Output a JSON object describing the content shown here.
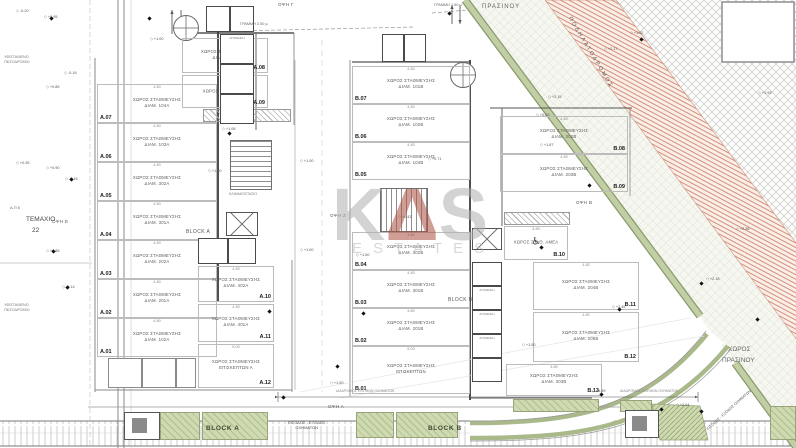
{
  "watermark": {
    "k": "K",
    "delta": "Δ",
    "s": "S",
    "sub": "ESTATES",
    "gray": "#b0b0b0",
    "red": "#ad4f41"
  },
  "areas": {
    "green_top": "ΠΡΑΣΙΝΟΥ",
    "bike_path": "ΠΟΔΗΛΑΤΟΔΡΟΜΟΣ",
    "green_corner_1": "ΧΩΡΟΣ",
    "green_corner_2": "ΠΡΑΣΙΝΟΥ",
    "plot_line1": "ΤΕΜΑΧΙΟ",
    "plot_line2": "22",
    "ap6": "Α.Π 6",
    "sidewalk_note_1": "ΥΦΙΣΤΑΜΕΝΟ",
    "sidewalk_note_2": "ΠΕΖΟΔΡΟΜΙΟ",
    "entry_1": "ΕΙΣΟΔΟΣ - ΕΞΟΔΟΣ",
    "entry_2": "ΟΧΗΜΑΤΩΝ",
    "entry_diag": "ΕΙΣΟΔΟΣ - ΕΞΟΔΟΣ ΟΧΗΜΑΤΩΝ",
    "line_250": "ΓΡΑΜΜΗ 2.50 μ",
    "line_150": "ΓΡΑΜΜΗ 1.50 μ",
    "corridor": "ΔΙΑΔΡΟΜΟΣ ΕΛΙΓΜΩΝ ΟΧΗΜΑΤΩΝ"
  },
  "blocks": {
    "a": "BLOCK A",
    "b": "BLOCK B",
    "a_bottom": "BLOCK A",
    "b_bottom": "BLOCK B"
  },
  "cores": {
    "stair": "ΚΛΙΜΑΚΟΣΤΑΣΙΟ",
    "storage": "ΑΠΟΘΗΚΗ"
  },
  "icons": {
    "wheelchair": "♿"
  },
  "facade_labels": [
    {
      "t": "ΟΨΗ Γ",
      "x": 278,
      "y": 2
    },
    {
      "t": "ΟΨΗ Ζ",
      "x": 330,
      "y": 213
    },
    {
      "t": "ΟΨΗ Ε",
      "x": 52,
      "y": 219
    },
    {
      "t": "ΟΨΗ Β",
      "x": 576,
      "y": 200
    },
    {
      "t": "ΟΨΗ Α",
      "x": 328,
      "y": 404
    }
  ],
  "stalls": [
    {
      "id": "A.07",
      "x": 97,
      "y": 84,
      "w": 120,
      "h": 39,
      "dim": "4.80",
      "l1": "ΧΩΡΟΣ ΣΤΑΘΜΕΥΣΗΣ",
      "l2": "ΔΙΑΜ. 104Α",
      "side": "bl"
    },
    {
      "id": "A.06",
      "x": 97,
      "y": 123,
      "w": 120,
      "h": 39,
      "dim": "4.80",
      "l1": "ΧΩΡΟΣ ΣΤΑΘΜΕΥΣΗΣ",
      "l2": "ΔΙΑΜ. 103Α",
      "side": "bl"
    },
    {
      "id": "A.05",
      "x": 97,
      "y": 162,
      "w": 120,
      "h": 39,
      "dim": "4.80",
      "l1": "ΧΩΡΟΣ ΣΤΑΘΜΕΥΣΗΣ",
      "l2": "ΔΙΑΜ. 302Α",
      "side": "bl"
    },
    {
      "id": "A.04",
      "x": 97,
      "y": 201,
      "w": 120,
      "h": 39,
      "dim": "4.80",
      "l1": "ΧΩΡΟΣ ΣΤΑΘΜΕΥΣΗΣ",
      "l2": "ΔΙΑΜ. 301Α",
      "side": "bl"
    },
    {
      "id": "A.03",
      "x": 97,
      "y": 240,
      "w": 120,
      "h": 39,
      "dim": "4.80",
      "l1": "ΧΩΡΟΣ ΣΤΑΘΜΕΥΣΗΣ",
      "l2": "ΔΙΑΜ. 202Α",
      "side": "bl"
    },
    {
      "id": "A.02",
      "x": 97,
      "y": 279,
      "w": 120,
      "h": 39,
      "dim": "4.80",
      "l1": "ΧΩΡΟΣ ΣΤΑΘΜΕΥΣΗΣ",
      "l2": "ΔΙΑΜ. 201Α",
      "side": "bl"
    },
    {
      "id": "A.01",
      "x": 97,
      "y": 318,
      "w": 120,
      "h": 39,
      "dim": "4.80",
      "l1": "ΧΩΡΟΣ ΣΤΑΘΜΕΥΣΗΣ",
      "l2": "ΔΙΑΜ. 102Α",
      "side": "bl"
    },
    {
      "id": "A.08",
      "x": 182,
      "y": 38,
      "w": 86,
      "h": 35,
      "dim": "4.80",
      "l1": "ΧΩΡΟΣ ΣΤΑΘΜΕΥΣΗΣ",
      "l2": "ΔΙΑΜ. 101Α",
      "side": "br"
    },
    {
      "id": "A.09",
      "x": 182,
      "y": 75,
      "w": 86,
      "h": 33,
      "dim": "4.80",
      "l1": "ΧΩΡΟΣ ΣΤΑΘ. ΑΜΕΑ",
      "l2": "",
      "side": "br",
      "amea": true
    },
    {
      "id": "A.10",
      "x": 198,
      "y": 266,
      "w": 76,
      "h": 36,
      "dim": "4.80",
      "l1": "ΧΩΡΟΣ ΣΤΑΘΜΕΥΣΗΣ",
      "l2": "ΔΙΑΜ. 402Α",
      "side": "br"
    },
    {
      "id": "A.11",
      "x": 198,
      "y": 304,
      "w": 76,
      "h": 38,
      "dim": "4.80",
      "l1": "ΧΩΡΟΣ ΣΤΑΘΜΕΥΣΗΣ",
      "l2": "ΔΙΑΜ. 401Α",
      "side": "br"
    },
    {
      "id": "A.12",
      "x": 198,
      "y": 344,
      "w": 76,
      "h": 44,
      "dim": "5.00",
      "l1": "ΧΩΡΟΣ ΣΤΑΘΜΕΥΣΗΣ",
      "l2": "ΕΠΙΣΚΕΠΤΩΝ Α",
      "side": "br"
    },
    {
      "id": "B.07",
      "x": 352,
      "y": 66,
      "w": 118,
      "h": 38,
      "dim": "4.80",
      "l1": "ΧΩΡΟΣ ΣΤΑΘΜΕΥΣΗΣ",
      "l2": "ΔΙΑΜ. 101Β",
      "side": "bl"
    },
    {
      "id": "B.06",
      "x": 352,
      "y": 104,
      "w": 118,
      "h": 38,
      "dim": "4.80",
      "l1": "ΧΩΡΟΣ ΣΤΑΘΜΕΥΣΗΣ",
      "l2": "ΔΙΑΜ. 102Β",
      "side": "bl"
    },
    {
      "id": "B.05",
      "x": 352,
      "y": 142,
      "w": 118,
      "h": 38,
      "dim": "4.80",
      "l1": "ΧΩΡΟΣ ΣΤΑΘΜΕΥΣΗΣ",
      "l2": "ΔΙΑΜ. 104Β",
      "side": "bl"
    },
    {
      "id": "B.04",
      "x": 352,
      "y": 232,
      "w": 118,
      "h": 38,
      "dim": "4.80",
      "l1": "ΧΩΡΟΣ ΣΤΑΘΜΕΥΣΗΣ",
      "l2": "ΔΙΑΜ. 302Β",
      "side": "bl"
    },
    {
      "id": "B.03",
      "x": 352,
      "y": 270,
      "w": 118,
      "h": 38,
      "dim": "4.80",
      "l1": "ΧΩΡΟΣ ΣΤΑΘΜΕΥΣΗΣ",
      "l2": "ΔΙΑΜ. 301Β",
      "side": "bl"
    },
    {
      "id": "B.02",
      "x": 352,
      "y": 308,
      "w": 118,
      "h": 38,
      "dim": "4.80",
      "l1": "ΧΩΡΟΣ ΣΤΑΘΜΕΥΣΗΣ",
      "l2": "ΔΙΑΜ. 201Β",
      "side": "bl"
    },
    {
      "id": "B.01",
      "x": 352,
      "y": 346,
      "w": 118,
      "h": 48,
      "dim": "5.00",
      "l1": "ΧΩΡΟΣ ΣΤΑΘΜΕΥΣΗΣ",
      "l2": "ΕΠΙΣΚΕΠΤΩΝ",
      "side": "bl"
    },
    {
      "id": "B.08",
      "x": 500,
      "y": 116,
      "w": 128,
      "h": 38,
      "dim": "4.80",
      "l1": "ΧΩΡΟΣ ΣΤΑΘΜΕΥΣΗΣ",
      "l2": "ΔΙΑΜ. 202Β",
      "side": "br"
    },
    {
      "id": "B.09",
      "x": 500,
      "y": 154,
      "w": 128,
      "h": 38,
      "dim": "4.80",
      "l1": "ΧΩΡΟΣ ΣΤΑΘΜΕΥΣΗΣ",
      "l2": "ΔΙΑΜ. 203Β",
      "side": "br"
    },
    {
      "id": "B.10",
      "x": 504,
      "y": 226,
      "w": 64,
      "h": 34,
      "dim": "4.80",
      "l1": "ΧΩΡΟΣ ΣΤΑΘ. ΑΜΕΑ",
      "l2": "",
      "side": "br",
      "amea": true
    },
    {
      "id": "B.11",
      "x": 533,
      "y": 262,
      "w": 106,
      "h": 48,
      "dim": "4.80",
      "l1": "ΧΩΡΟΣ ΣΤΑΘΜΕΥΣΗΣ",
      "l2": "ΔΙΑΜ. 204Β",
      "side": "br"
    },
    {
      "id": "B.12",
      "x": 533,
      "y": 312,
      "w": 106,
      "h": 50,
      "dim": "4.80",
      "l1": "ΧΩΡΟΣ ΣΤΑΘΜΕΥΣΗΣ",
      "l2": "ΔΙΑΜ. 205Β",
      "side": "br"
    },
    {
      "id": "B.13",
      "x": 506,
      "y": 364,
      "w": 96,
      "h": 32,
      "dim": "4.80",
      "l1": "ΧΩΡΟΣ ΣΤΑΘΜΕΥΣΗΣ",
      "l2": "ΔΙΑΜ. 303Β",
      "side": "br"
    }
  ],
  "cells": [
    {
      "x": 220,
      "y": 34,
      "w": 34,
      "h": 30,
      "lbl": "ΑΠΟΘΗΚΗ"
    },
    {
      "x": 220,
      "y": 64,
      "w": 34,
      "h": 30,
      "lbl": ""
    },
    {
      "x": 220,
      "y": 94,
      "w": 34,
      "h": 30,
      "lbl": ""
    },
    {
      "x": 198,
      "y": 238,
      "w": 30,
      "h": 26,
      "lbl": ""
    },
    {
      "x": 228,
      "y": 238,
      "w": 28,
      "h": 26,
      "lbl": ""
    },
    {
      "x": 206,
      "y": 6,
      "w": 24,
      "h": 26,
      "lbl": ""
    },
    {
      "x": 230,
      "y": 6,
      "w": 24,
      "h": 26,
      "lbl": ""
    },
    {
      "x": 382,
      "y": 34,
      "w": 22,
      "h": 28,
      "lbl": ""
    },
    {
      "x": 404,
      "y": 34,
      "w": 22,
      "h": 28,
      "lbl": ""
    },
    {
      "x": 472,
      "y": 262,
      "w": 30,
      "h": 24,
      "lbl": ""
    },
    {
      "x": 472,
      "y": 286,
      "w": 30,
      "h": 24,
      "lbl": "ΑΠΟΘΗΚΗ"
    },
    {
      "x": 472,
      "y": 310,
      "w": 30,
      "h": 24,
      "lbl": "ΑΠΟΘΗΚΗ"
    },
    {
      "x": 472,
      "y": 334,
      "w": 30,
      "h": 24,
      "lbl": "ΑΠΟΘΗΚΗ"
    },
    {
      "x": 472,
      "y": 358,
      "w": 30,
      "h": 24,
      "lbl": ""
    },
    {
      "x": 108,
      "y": 358,
      "w": 34,
      "h": 30,
      "lbl": "",
      "thin": true
    },
    {
      "x": 142,
      "y": 358,
      "w": 34,
      "h": 30,
      "lbl": "",
      "thin": true
    },
    {
      "x": 176,
      "y": 358,
      "w": 20,
      "h": 30,
      "lbl": "",
      "thin": true
    }
  ],
  "elevations": [
    {
      "x": 16,
      "y": 8,
      "v": "-0.20"
    },
    {
      "x": 44,
      "y": 14,
      "v": "+0.95"
    },
    {
      "x": 64,
      "y": 70,
      "v": "-0.16"
    },
    {
      "x": 46,
      "y": 84,
      "v": "+0.85"
    },
    {
      "x": 150,
      "y": 36,
      "v": "+1.00"
    },
    {
      "x": 16,
      "y": 160,
      "v": "+0.35"
    },
    {
      "x": 46,
      "y": 165,
      "v": "+0.90"
    },
    {
      "x": 65,
      "y": 176,
      "v": "-0.16"
    },
    {
      "x": 46,
      "y": 248,
      "v": "+0.85"
    },
    {
      "x": 62,
      "y": 284,
      "v": "-0.14"
    },
    {
      "x": 222,
      "y": 126,
      "v": "+1.06"
    },
    {
      "x": 208,
      "y": 168,
      "v": "+1.50"
    },
    {
      "x": 300,
      "y": 158,
      "v": "+1.00"
    },
    {
      "x": 300,
      "y": 247,
      "v": "+1.00"
    },
    {
      "x": 428,
      "y": 156,
      "v": "+0.71"
    },
    {
      "x": 398,
      "y": 214,
      "v": "+0.43"
    },
    {
      "x": 356,
      "y": 252,
      "v": "+1.50"
    },
    {
      "x": 536,
      "y": 112,
      "v": "+0.63"
    },
    {
      "x": 604,
      "y": 46,
      "v": "+2.17"
    },
    {
      "x": 548,
      "y": 94,
      "v": "+2.15"
    },
    {
      "x": 540,
      "y": 142,
      "v": "+1.87"
    },
    {
      "x": 630,
      "y": 30,
      "v": "+1.02"
    },
    {
      "x": 758,
      "y": 90,
      "v": "+1.93"
    },
    {
      "x": 706,
      "y": 276,
      "v": "+2.18"
    },
    {
      "x": 612,
      "y": 304,
      "v": "+2.45"
    },
    {
      "x": 592,
      "y": 388,
      "v": "+1.89"
    },
    {
      "x": 676,
      "y": 402,
      "v": "+2.64"
    },
    {
      "x": 736,
      "y": 226,
      "v": "+2.36"
    },
    {
      "x": 522,
      "y": 342,
      "v": "+1.50"
    },
    {
      "x": 330,
      "y": 380,
      "v": "+1.50"
    }
  ],
  "markers": [
    {
      "x": 50,
      "y": 17
    },
    {
      "x": 148,
      "y": 17
    },
    {
      "x": 70,
      "y": 178
    },
    {
      "x": 52,
      "y": 250
    },
    {
      "x": 66,
      "y": 286
    },
    {
      "x": 228,
      "y": 132
    },
    {
      "x": 268,
      "y": 310
    },
    {
      "x": 282,
      "y": 396
    },
    {
      "x": 362,
      "y": 312
    },
    {
      "x": 336,
      "y": 365
    },
    {
      "x": 540,
      "y": 246
    },
    {
      "x": 588,
      "y": 184
    },
    {
      "x": 640,
      "y": 38
    },
    {
      "x": 700,
      "y": 282
    },
    {
      "x": 618,
      "y": 308
    },
    {
      "x": 600,
      "y": 393
    },
    {
      "x": 660,
      "y": 408
    },
    {
      "x": 756,
      "y": 318
    },
    {
      "x": 700,
      "y": 410
    },
    {
      "x": 448,
      "y": 12
    }
  ]
}
